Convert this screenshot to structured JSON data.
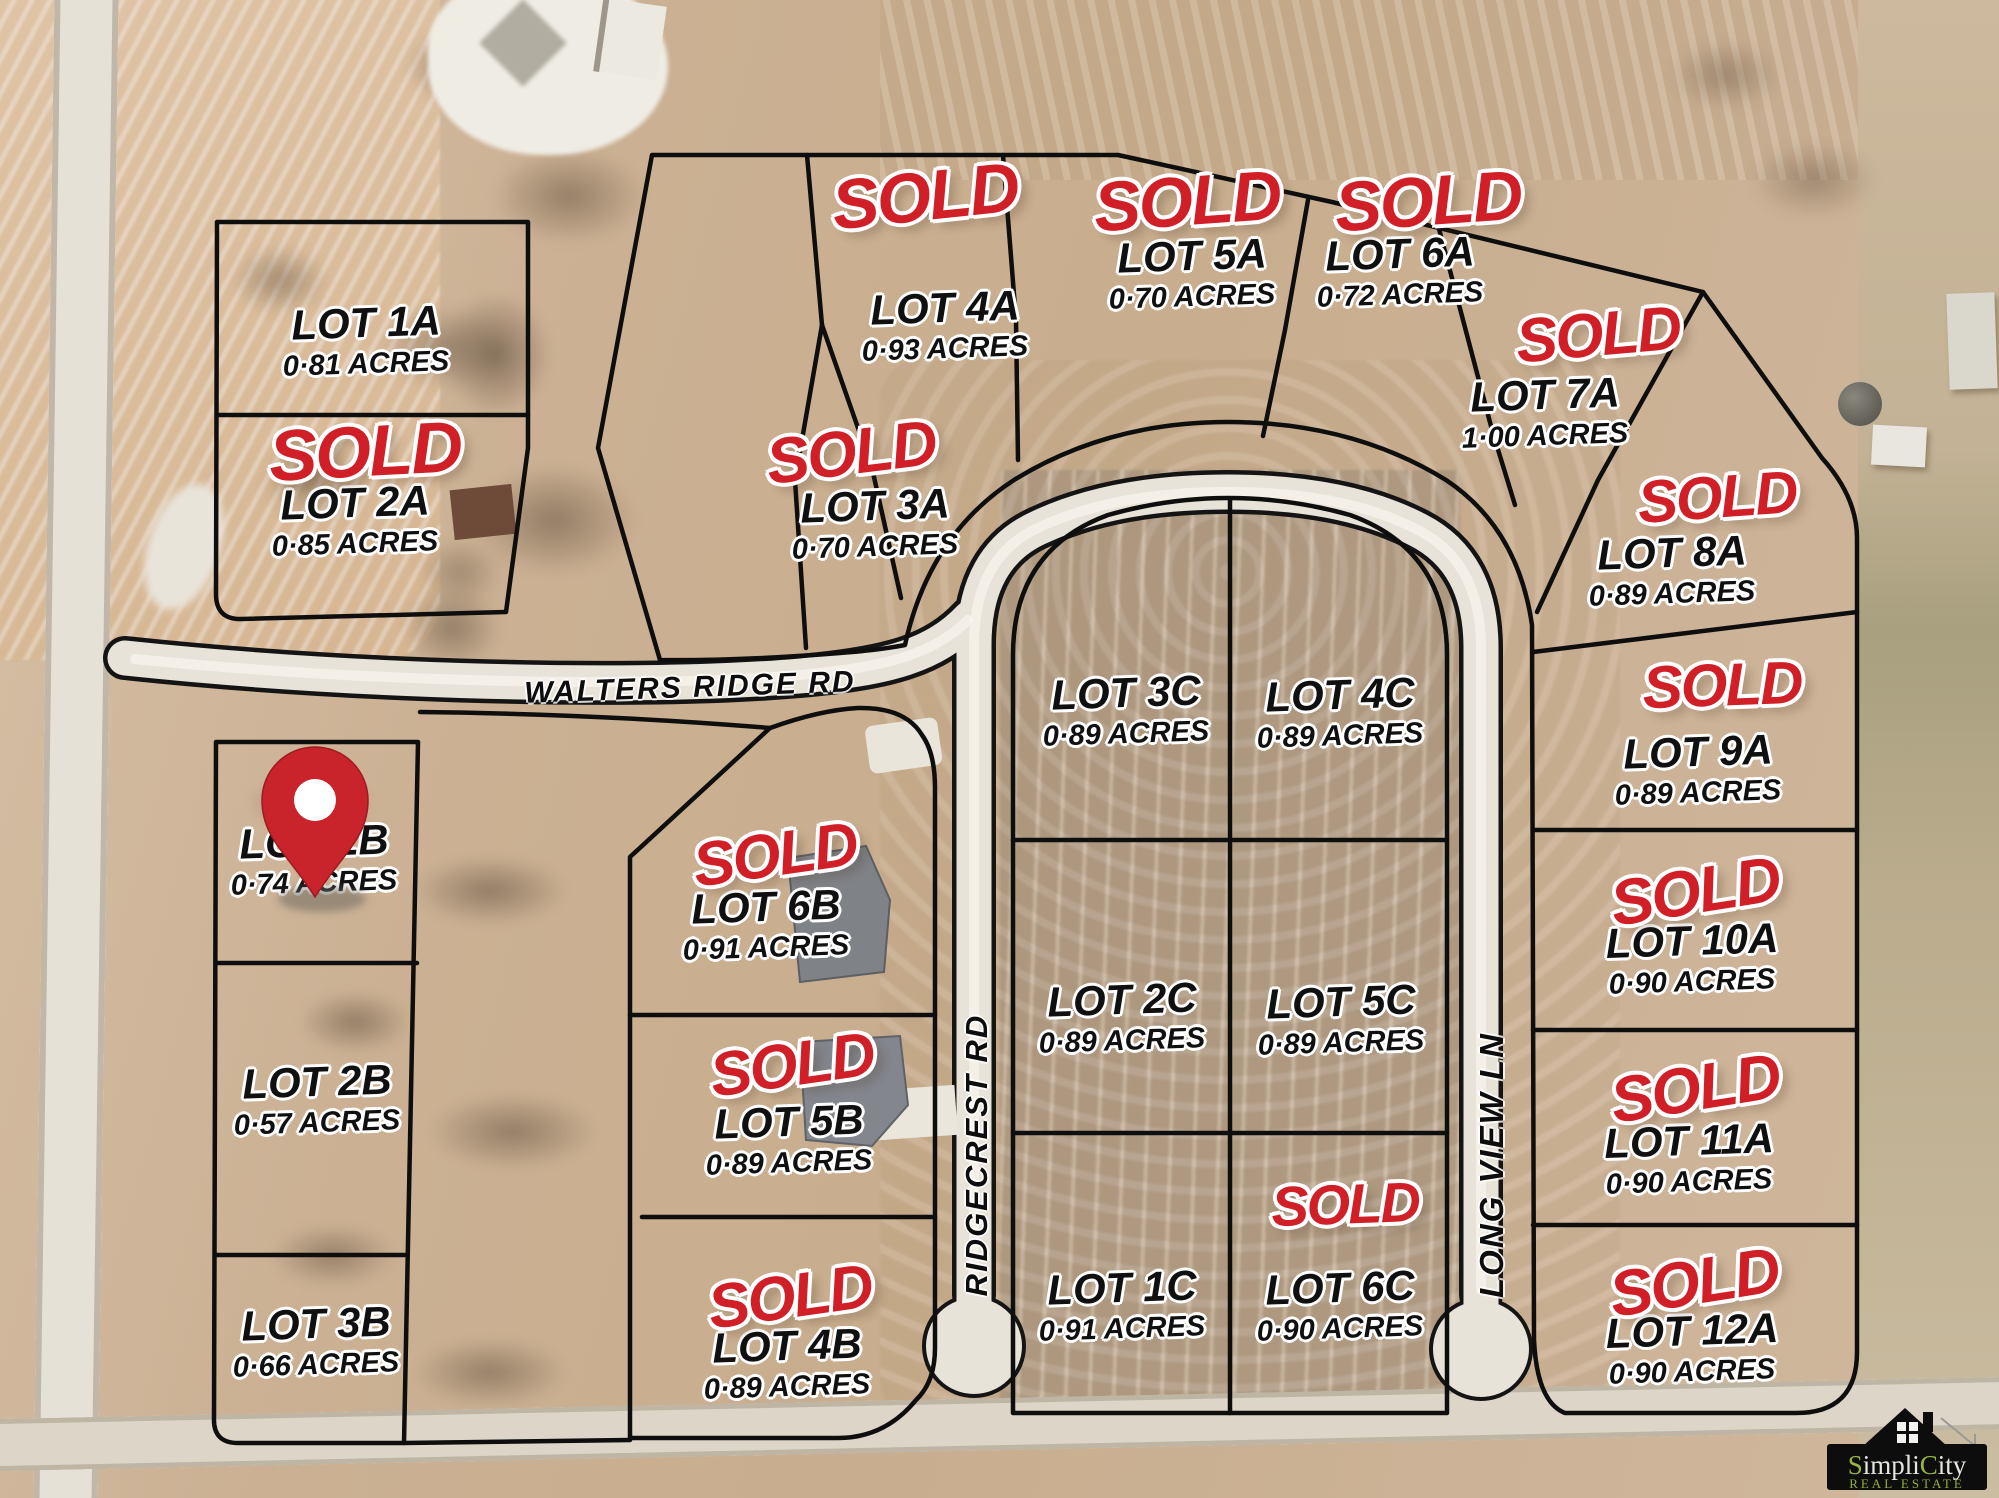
{
  "sold_label": "SOLD",
  "roads": [
    {
      "name": "WALTERS RIDGE RD"
    },
    {
      "name": "RIDGECREST RD"
    },
    {
      "name": "LONG VIEW LN"
    }
  ],
  "lots": [
    {
      "id": "1A",
      "name": "LOT 1A",
      "acres": "0·81 ACRES",
      "sold": false
    },
    {
      "id": "2A",
      "name": "LOT 2A",
      "acres": "0·85 ACRES",
      "sold": true
    },
    {
      "id": "3A",
      "name": "LOT 3A",
      "acres": "0·70 ACRES",
      "sold": true
    },
    {
      "id": "4A",
      "name": "LOT 4A",
      "acres": "0·93 ACRES",
      "sold": true
    },
    {
      "id": "5A",
      "name": "LOT 5A",
      "acres": "0·70 ACRES",
      "sold": true
    },
    {
      "id": "6A",
      "name": "LOT 6A",
      "acres": "0·72 ACRES",
      "sold": true
    },
    {
      "id": "7A",
      "name": "LOT 7A",
      "acres": "1·00 ACRES",
      "sold": true
    },
    {
      "id": "8A",
      "name": "LOT 8A",
      "acres": "0·89 ACRES",
      "sold": true
    },
    {
      "id": "9A",
      "name": "LOT 9A",
      "acres": "0·89 ACRES",
      "sold": true
    },
    {
      "id": "10A",
      "name": "LOT 10A",
      "acres": "0·90 ACRES",
      "sold": true
    },
    {
      "id": "11A",
      "name": "LOT 11A",
      "acres": "0·90 ACRES",
      "sold": true
    },
    {
      "id": "12A",
      "name": "LOT 12A",
      "acres": "0·90 ACRES",
      "sold": true
    },
    {
      "id": "1B",
      "name": "LOT 1B",
      "acres": "0·74 ACRES",
      "sold": false
    },
    {
      "id": "2B",
      "name": "LOT 2B",
      "acres": "0·57 ACRES",
      "sold": false
    },
    {
      "id": "3B",
      "name": "LOT 3B",
      "acres": "0·66 ACRES",
      "sold": false
    },
    {
      "id": "4B",
      "name": "LOT 4B",
      "acres": "0·89 ACRES",
      "sold": true
    },
    {
      "id": "5B",
      "name": "LOT 5B",
      "acres": "0·89 ACRES",
      "sold": true
    },
    {
      "id": "6B",
      "name": "LOT 6B",
      "acres": "0·91 ACRES",
      "sold": true
    },
    {
      "id": "1C",
      "name": "LOT 1C",
      "acres": "0·91 ACRES",
      "sold": false
    },
    {
      "id": "2C",
      "name": "LOT 2C",
      "acres": "0·89 ACRES",
      "sold": false
    },
    {
      "id": "3C",
      "name": "LOT 3C",
      "acres": "0·89 ACRES",
      "sold": false
    },
    {
      "id": "4C",
      "name": "LOT 4C",
      "acres": "0·89 ACRES",
      "sold": false
    },
    {
      "id": "5C",
      "name": "LOT 5C",
      "acres": "0·89 ACRES",
      "sold": false
    },
    {
      "id": "6C",
      "name": "LOT 6C",
      "acres": "0·90 ACRES",
      "sold": true
    }
  ],
  "marker": {
    "icon": "map-pin",
    "lot": "LOT 1B",
    "color": "#c9232b"
  },
  "logo": {
    "brand_s": "S",
    "brand_impli": "impli",
    "brand_c": "C",
    "brand_ity": "ity",
    "tagline": "REAL ESTATE"
  },
  "colors": {
    "sold_red": "#d01f26",
    "lot_text": "#101010",
    "halo": "#ffffff"
  }
}
